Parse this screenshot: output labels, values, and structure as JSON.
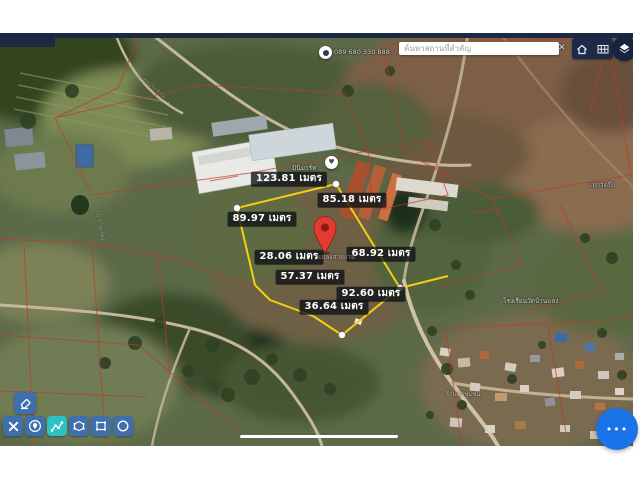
{
  "topbar": {
    "search_placeholder": "ค้นหาสถานที่สำคัญ",
    "clear_label": "✕",
    "control_icons": [
      "home-icon",
      "grid-icon",
      "layers-icon"
    ]
  },
  "measurements": [
    "123.81 เมตร",
    "85.18 เมตร",
    "89.97 เมตร",
    "28.06 เมตร",
    "68.92 เมตร",
    "57.37 เมตร",
    "92.60 เมตร",
    "36.64 เมตร"
  ],
  "map_labels": {
    "poi_phone": "089 680 330 888",
    "shop": "มินิมาร์ท",
    "pin_caption": "แปลงสวยงาม",
    "junction": "แยกวัดบึง",
    "school": "โรงเรียนวัดบ้านแลง",
    "road_left": "ถ.บ้านแลง",
    "canal": "ถ.ชลประทาน",
    "village_shop": "ร้านค้าชุมชน"
  },
  "toolbar": {
    "top_tool": {
      "icon": "eraser-icon"
    },
    "tools": [
      {
        "icon": "delete-x-icon",
        "active": false
      },
      {
        "icon": "marker-icon",
        "active": false
      },
      {
        "icon": "measure-path-icon",
        "active": true
      },
      {
        "icon": "polygon-tool-icon",
        "active": false
      },
      {
        "icon": "rectangle-tool-icon",
        "active": false
      },
      {
        "icon": "circle-tool-icon",
        "active": false
      }
    ]
  },
  "fab": {
    "dots": "•••"
  },
  "colors": {
    "accent_blue": "#3c6eb5",
    "active_teal": "#2cc2c4",
    "polygon_yellow": "#f2cf13",
    "pin_red": "#e23b30",
    "navy_bar": "#1b2942",
    "fab_blue": "#1a73e8"
  }
}
